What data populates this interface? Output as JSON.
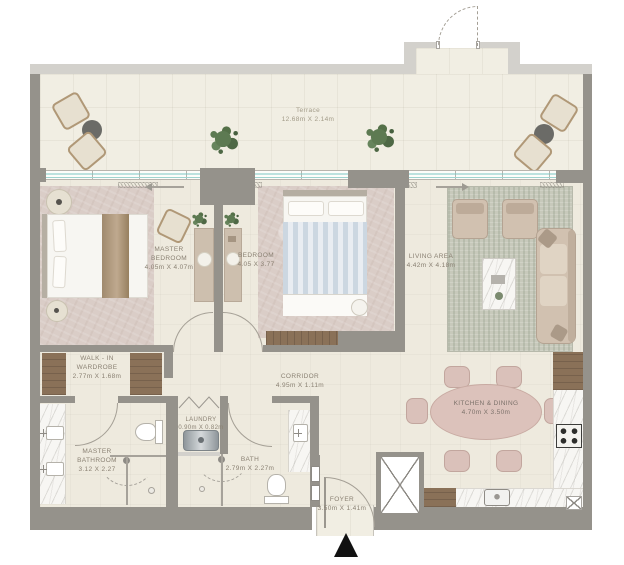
{
  "plan": {
    "rooms": {
      "terrace": {
        "name": "Terrace",
        "dims": "12.68m X 2.14m"
      },
      "master_bedroom": {
        "name": "MASTER BEDROOM",
        "dims": "4.05m X 4.07m"
      },
      "bedroom": {
        "name": "BEDROOM",
        "dims": "4.05 X 3.77"
      },
      "living_area": {
        "name": "LIVING AREA",
        "dims": "4.42m X 4.18m"
      },
      "walk_in_wardrobe": {
        "name": "WALK - IN WARDROBE",
        "dims": "2.77m X 1.68m"
      },
      "corridor": {
        "name": "CORRIDOR",
        "dims": "4.95m X 1.11m"
      },
      "master_bathroom": {
        "name": "MASTER BATHROOM",
        "dims": "3.12 X 2.27"
      },
      "laundry": {
        "name": "LAUNDRY",
        "dims": "0.90m X 0.82m"
      },
      "bath": {
        "name": "BATH",
        "dims": "2.79m X 2.27m"
      },
      "kitchen_dining": {
        "name": "KITCHEN & DINING",
        "dims": "4.70m X 3.50m"
      },
      "foyer": {
        "name": "FOYER",
        "dims": "3.50m X 1.41m"
      }
    },
    "colors": {
      "wall": "#95928b",
      "wall_light": "#d3d1cc",
      "floor": "#eeeade",
      "terrace_floor": "#f1eee3",
      "carpet": "#dacdc7",
      "rug": "#c7c9bb",
      "wood": "#8a7158",
      "window_glass": "#7cc7c4",
      "dining_table": "#dcc2bb",
      "upholstery": "#d1c1b0",
      "entrance_marker": "#111111"
    }
  }
}
